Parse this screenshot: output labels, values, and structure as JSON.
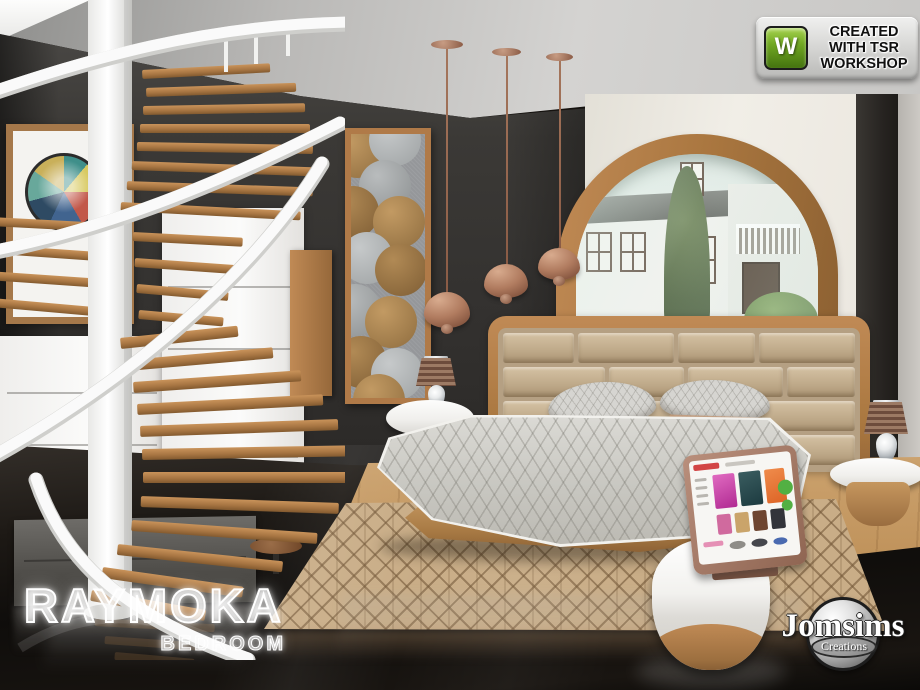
{
  "workshop_badge": {
    "icon_letter": "W",
    "line1": "CREATED",
    "line2": "WITH TSR",
    "line3": "WORKSHOP"
  },
  "title": {
    "name": "RAYMOKA",
    "category": "BEDROOM"
  },
  "creator": {
    "name": "Jomsims",
    "subtitle": "Creations"
  },
  "colors": {
    "wood": "#b3804e",
    "copper_pendant": "#a5715a",
    "wall_dark": "#3b3936",
    "wall_cream": "#ece9e1",
    "headboard_tan": "#c2ae90",
    "bedding_gray": "#cfcec9",
    "rug_tan": "#c9ad87",
    "floor_gloss": "#15120f",
    "workshop_green": "#71a823",
    "white_furniture": "#f4f3f1"
  }
}
